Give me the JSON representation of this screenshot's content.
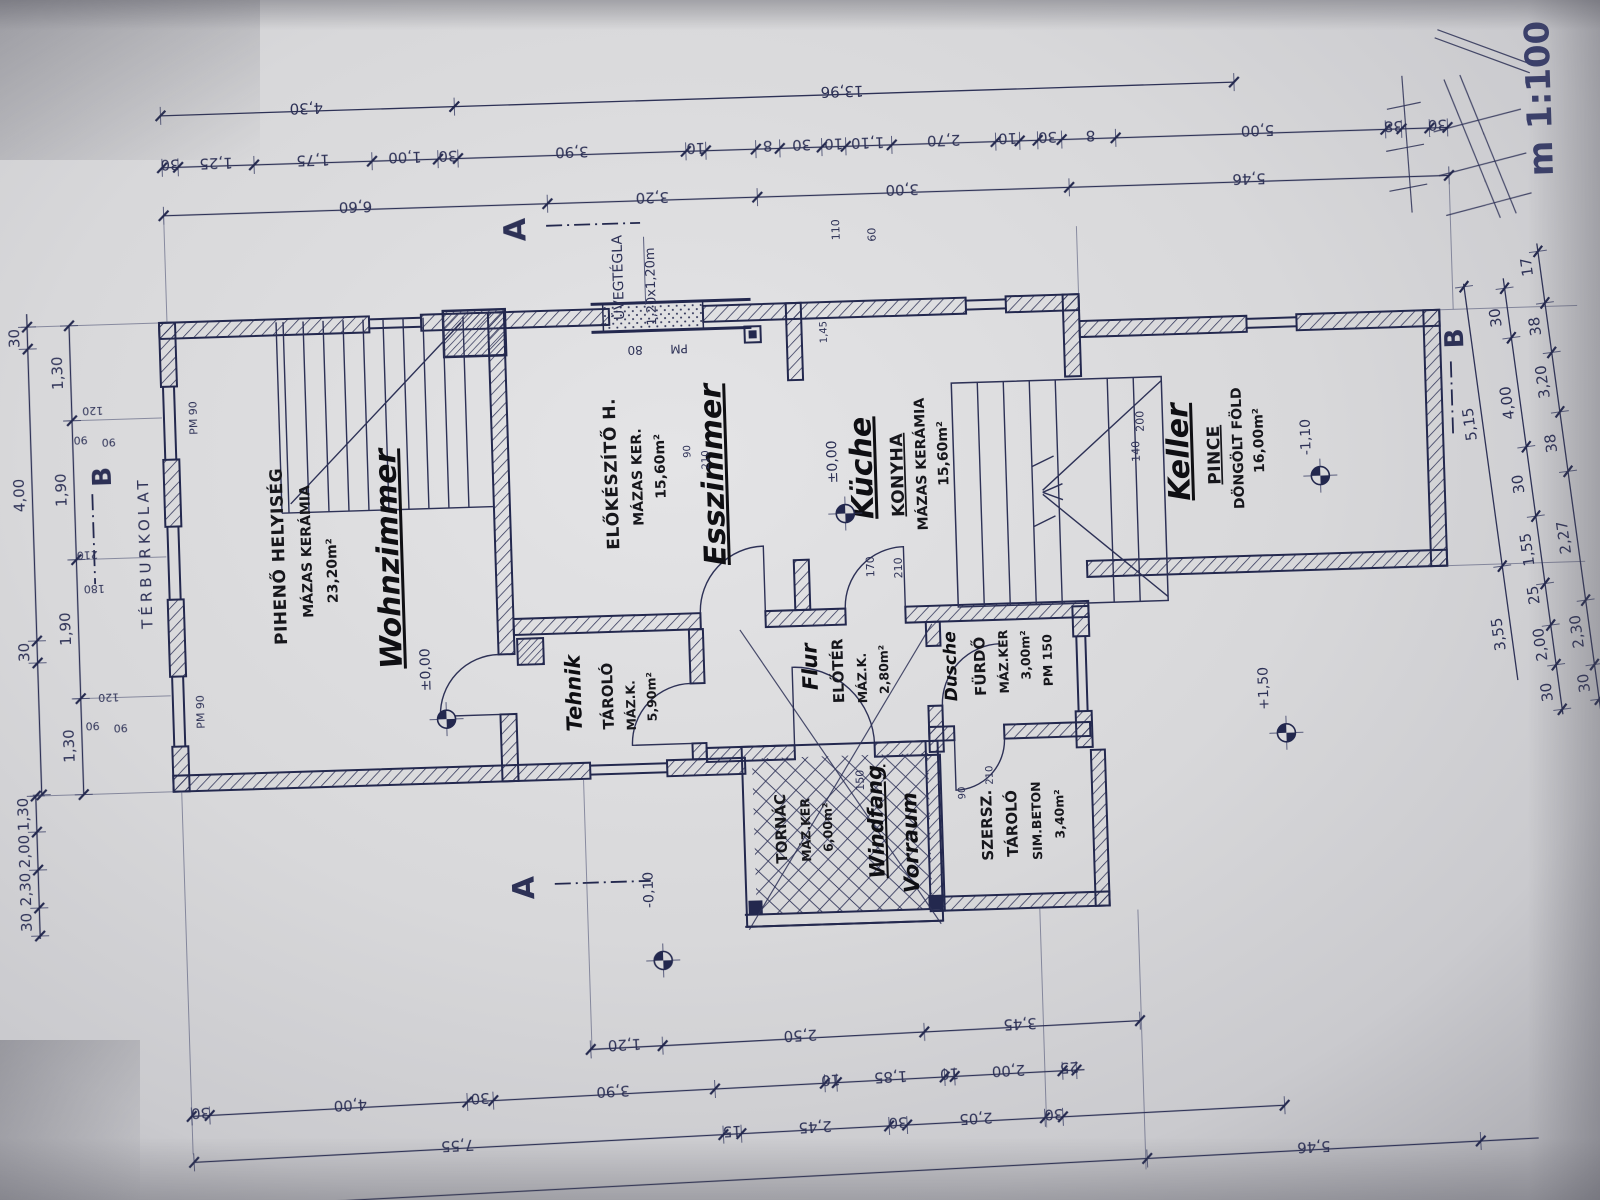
{
  "meta": {
    "scale_note": "m 1:100",
    "ink": "#2d3156",
    "marker": "#141418",
    "paper": "#d6d6d9"
  },
  "rooms": [
    {
      "key": "wohnzimmer",
      "lines": [
        {
          "t": "PIHENŐ HELYISÉG",
          "x": 286,
          "y": 540,
          "c": "room-hu"
        },
        {
          "t": "MÁZAS KERÁMIA",
          "x": 313,
          "y": 536,
          "c": "room-sub"
        },
        {
          "t": "23,20m²",
          "x": 338,
          "y": 556,
          "c": "room-sub"
        },
        {
          "t": "Wohnzimmer",
          "x": 400,
          "y": 546,
          "c": "hand hand-big u"
        }
      ]
    },
    {
      "key": "esszimmer",
      "lines": [
        {
          "t": "ELŐKÉSZÍTŐ H.",
          "x": 621,
          "y": 468,
          "c": "room-hu"
        },
        {
          "t": "MÁZAS KER.",
          "x": 646,
          "y": 472,
          "c": "room-sub"
        },
        {
          "t": "15,60m²",
          "x": 669,
          "y": 462,
          "c": "room-sub"
        },
        {
          "t": "Esszimmer",
          "x": 727,
          "y": 472,
          "c": "hand hand-big u"
        }
      ]
    },
    {
      "key": "kueche",
      "lines": [
        {
          "t": "Küche",
          "x": 876,
          "y": 470,
          "c": "hand hand-big u"
        },
        {
          "t": "KONYHA",
          "x": 907,
          "y": 478,
          "c": "room-hu u"
        },
        {
          "t": "MÁZAS KERÁMIA",
          "x": 930,
          "y": 468,
          "c": "room-sub"
        },
        {
          "t": "15,60m²",
          "x": 952,
          "y": 458,
          "c": "room-sub"
        }
      ]
    },
    {
      "key": "keller",
      "lines": [
        {
          "t": "Keller",
          "x": 1193,
          "y": 464,
          "c": "hand hand-big u"
        },
        {
          "t": "PINCE",
          "x": 1224,
          "y": 468,
          "c": "room-hu u"
        },
        {
          "t": "DÖNGÖLT FÖLD",
          "x": 1247,
          "y": 462,
          "c": "room-sub"
        },
        {
          "t": "16,00m²",
          "x": 1268,
          "y": 455,
          "c": "room-sub"
        }
      ]
    },
    {
      "key": "tarolo",
      "lines": [
        {
          "t": "Tehnik",
          "x": 578,
          "y": 686,
          "c": "hand hand-med"
        },
        {
          "t": "TÁROLÓ",
          "x": 610,
          "y": 690,
          "c": "room-hu-sm"
        },
        {
          "t": "MÁZ.K.",
          "x": 632,
          "y": 700,
          "c": "room-sub-sm"
        },
        {
          "t": "5,90m²",
          "x": 653,
          "y": 692,
          "c": "room-sub-sm"
        }
      ]
    },
    {
      "key": "flur",
      "lines": [
        {
          "t": "Flur",
          "x": 815,
          "y": 667,
          "c": "hand hand-med"
        },
        {
          "t": "ELŐTÉR",
          "x": 841,
          "y": 672,
          "c": "room-hu-sm"
        },
        {
          "t": "MÁZ.K.",
          "x": 864,
          "y": 680,
          "c": "room-sub-sm"
        },
        {
          "t": "2,80m²",
          "x": 886,
          "y": 672,
          "c": "room-sub-sm"
        }
      ]
    },
    {
      "key": "fuerdo",
      "lines": [
        {
          "t": "Dusche",
          "x": 954,
          "y": 671,
          "c": "hand hand-sm"
        },
        {
          "t": "FÜRDŐ",
          "x": 983,
          "y": 672,
          "c": "room-hu-sm"
        },
        {
          "t": "MÁZ.KER",
          "x": 1006,
          "y": 668,
          "c": "room-sub-sm"
        },
        {
          "t": "3,00m²",
          "x": 1028,
          "y": 662,
          "c": "room-sub-sm"
        },
        {
          "t": "PM 150",
          "x": 1050,
          "y": 668,
          "c": "room-sub-sm"
        }
      ]
    },
    {
      "key": "tornac",
      "lines": [
        {
          "t": "TORNÁC",
          "x": 779,
          "y": 828,
          "c": "room-hu-sm"
        },
        {
          "t": "MÁZ.KER",
          "x": 803,
          "y": 830,
          "c": "room-sub-sm"
        },
        {
          "t": "6,00m²",
          "x": 825,
          "y": 828,
          "c": "room-sub-sm"
        },
        {
          "t": "Windfang",
          "x": 876,
          "y": 824,
          "c": "hand hand-med u"
        },
        {
          "t": "Vorraum",
          "x": 910,
          "y": 846,
          "c": "hand hand-med"
        }
      ]
    },
    {
      "key": "szersz",
      "lines": [
        {
          "t": "SZERSZ.",
          "x": 985,
          "y": 831,
          "c": "room-hu-sm"
        },
        {
          "t": "TÁROLÓ",
          "x": 1010,
          "y": 830,
          "c": "room-hu-sm"
        },
        {
          "t": "SIM.BETON",
          "x": 1034,
          "y": 828,
          "c": "room-sub-sm"
        },
        {
          "t": "3,40m²",
          "x": 1057,
          "y": 822,
          "c": "room-sub-sm"
        }
      ]
    }
  ],
  "labels": [
    {
      "t": "m 1:100",
      "x": 1566,
      "y": 122,
      "s": 34,
      "c": "ann scale",
      "n": "scale-note"
    },
    {
      "t": "TÉRBURKOLAT",
      "x": 152,
      "y": 532,
      "s": 15,
      "c": "ann ls",
      "n": "terburkolat-label"
    },
    {
      "t": "ÜVEGTÉGLA",
      "x": 633,
      "y": 272,
      "s": 14,
      "c": "ann",
      "n": "glass-block-label"
    },
    {
      "t": "1,20x1,20m",
      "x": 665,
      "y": 282,
      "s": 13,
      "c": "ann",
      "n": "glass-block-size"
    },
    {
      "t": "80",
      "x": 643,
      "y": 341,
      "r": 180,
      "s": 12,
      "c": "ann"
    },
    {
      "t": "PM",
      "x": 687,
      "y": 341,
      "r": 180,
      "s": 12,
      "c": "ann"
    },
    {
      "t": "PM 90",
      "x": 203,
      "y": 399,
      "s": 11,
      "c": "ann"
    },
    {
      "t": "PM 90",
      "x": 201,
      "y": 693,
      "s": 11,
      "c": "ann"
    },
    {
      "t": "120",
      "x": 99,
      "y": 385,
      "r": 180,
      "s": 11,
      "c": "ann"
    },
    {
      "t": "90",
      "x": 86,
      "y": 414,
      "r": 180,
      "s": 11,
      "c": "ann"
    },
    {
      "t": "90",
      "x": 114,
      "y": 417,
      "r": 180,
      "s": 11,
      "c": "ann"
    },
    {
      "t": "210",
      "x": 89,
      "y": 529,
      "r": 180,
      "s": 11,
      "c": "ann"
    },
    {
      "t": "180",
      "x": 95,
      "y": 563,
      "r": 180,
      "s": 11,
      "c": "ann"
    },
    {
      "t": "120",
      "x": 106,
      "y": 672,
      "r": 180,
      "s": 11,
      "c": "ann"
    },
    {
      "t": "90",
      "x": 89,
      "y": 700,
      "r": 180,
      "s": 11,
      "c": "ann"
    },
    {
      "t": "90",
      "x": 117,
      "y": 703,
      "r": 180,
      "s": 11,
      "c": "ann"
    },
    {
      "t": "110",
      "x": 851,
      "y": 231,
      "s": 11,
      "c": "ann"
    },
    {
      "t": "60",
      "x": 887,
      "y": 237,
      "s": 11,
      "c": "ann"
    },
    {
      "t": "1,45",
      "x": 835,
      "y": 333,
      "s": 10,
      "c": "ann"
    },
    {
      "t": "170",
      "x": 875,
      "y": 569,
      "s": 11,
      "c": "ann"
    },
    {
      "t": "210",
      "x": 903,
      "y": 571,
      "s": 11,
      "c": "ann"
    },
    {
      "t": "90",
      "x": 695,
      "y": 448,
      "s": 10,
      "c": "ann"
    },
    {
      "t": "210",
      "x": 713,
      "y": 457,
      "s": 10,
      "c": "ann"
    },
    {
      "t": "150",
      "x": 858,
      "y": 782,
      "s": 11,
      "c": "ann"
    },
    {
      "t": "90",
      "x": 959,
      "y": 798,
      "s": 10,
      "c": "ann"
    },
    {
      "t": "210",
      "x": 987,
      "y": 781,
      "s": 10,
      "c": "ann"
    },
    {
      "t": "200",
      "x": 1149,
      "y": 432,
      "s": 11,
      "c": "ann"
    },
    {
      "t": "140",
      "x": 1144,
      "y": 462,
      "s": 11,
      "c": "ann"
    },
    {
      "t": "±0,00",
      "x": 428,
      "y": 658,
      "s": 14,
      "c": "ann"
    },
    {
      "t": "±0,00",
      "x": 841,
      "y": 463,
      "s": 14,
      "c": "ann"
    },
    {
      "t": "-0,10",
      "x": 644,
      "y": 885,
      "s": 14,
      "c": "ann"
    },
    {
      "t": "+1,50",
      "x": 1265,
      "y": 703,
      "s": 14,
      "c": "ann"
    },
    {
      "t": "-1,10",
      "x": 1315,
      "y": 453,
      "s": 14,
      "c": "ann"
    },
    {
      "t": "A",
      "x": 537,
      "y": 221,
      "s": 30,
      "c": "ann secb",
      "n": "section-a-top"
    },
    {
      "t": "A",
      "x": 525,
      "y": 879,
      "s": 30,
      "c": "ann secb",
      "n": "section-a-bottom"
    },
    {
      "t": "B",
      "x": 115,
      "y": 455,
      "s": 26,
      "c": "ann secb",
      "n": "section-b-left"
    },
    {
      "t": "B",
      "x": 1471,
      "y": 359,
      "s": 26,
      "c": "ann secb",
      "n": "section-b-right"
    }
  ],
  "chains": [
    {
      "g": "top",
      "o": "h",
      "pos": 96,
      "from": 176,
      "to": 1250,
      "ticks": [
        176,
        470,
        1250
      ],
      "labels": [
        {
          "t": "4,30",
          "at": 322
        },
        {
          "t": "13,96",
          "at": 858
        }
      ]
    },
    {
      "g": "top",
      "o": "h",
      "pos": 148,
      "from": 176,
      "to": 1462,
      "ticks": [
        176,
        192,
        268,
        386,
        452,
        472,
        700,
        720,
        770,
        794,
        836,
        860,
        906,
        1010,
        1034,
        1052,
        1076,
        1130,
        1400,
        1416,
        1444,
        1462
      ],
      "labels": [
        {
          "t": "30",
          "at": 184
        },
        {
          "t": "1,25",
          "at": 230
        },
        {
          "t": "1,75",
          "at": 327
        },
        {
          "t": "1,00",
          "at": 419
        },
        {
          "t": "30",
          "at": 462
        },
        {
          "t": "3,90",
          "at": 586
        },
        {
          "t": "10",
          "at": 710
        },
        {
          "t": "8",
          "at": 782
        },
        {
          "t": "30",
          "at": 816
        },
        {
          "t": "10",
          "at": 848
        },
        {
          "t": "1,10",
          "at": 882
        },
        {
          "t": "2,70",
          "at": 958
        },
        {
          "t": "10",
          "at": 1022
        },
        {
          "t": "30",
          "at": 1062
        },
        {
          "t": "8",
          "at": 1105
        },
        {
          "t": "5,00",
          "at": 1272
        },
        {
          "t": "38",
          "at": 1408
        },
        {
          "t": "30",
          "at": 1452
        }
      ]
    },
    {
      "g": "top",
      "o": "h",
      "pos": 196,
      "from": 176,
      "to": 1462,
      "ticks": [
        176,
        560,
        770,
        1082,
        1462
      ],
      "labels": [
        {
          "t": "6,60",
          "at": 368
        },
        {
          "t": "3,20",
          "at": 665
        },
        {
          "t": "3,00",
          "at": 915
        },
        {
          "t": "5,46",
          "at": 1262
        }
      ]
    },
    {
      "g": "bottom",
      "o": "h",
      "pos": 1038,
      "from": 578,
      "to": 1128,
      "ticks": [
        578,
        650,
        912,
        1128
      ],
      "labels": [
        {
          "t": "1,20",
          "at": 612
        },
        {
          "t": "2,50",
          "at": 788
        },
        {
          "t": "3,45",
          "at": 1008
        }
      ]
    },
    {
      "g": "bottom",
      "o": "h",
      "pos": 1084,
      "from": 176,
      "to": 1070,
      "ticks": [
        176,
        194,
        452,
        478,
        700,
        810,
        822,
        930,
        940,
        1048,
        1062
      ],
      "labels": [
        {
          "t": "30",
          "at": 185
        },
        {
          "t": "4,00",
          "at": 335
        },
        {
          "t": "30",
          "at": 465
        },
        {
          "t": "3,90",
          "at": 598
        },
        {
          "t": "10",
          "at": 816
        },
        {
          "t": "1,85",
          "at": 876
        },
        {
          "t": "10",
          "at": 935
        },
        {
          "t": "2,00",
          "at": 994
        },
        {
          "t": "25",
          "at": 1055
        }
      ]
    },
    {
      "g": "bottom",
      "o": "h",
      "pos": 1130,
      "from": 176,
      "to": 1268,
      "ticks": [
        176,
        706,
        724,
        872,
        890,
        1028,
        1046,
        1268
      ],
      "labels": [
        {
          "t": "7,55",
          "at": 440
        },
        {
          "t": "15",
          "at": 715
        },
        {
          "t": "2,45",
          "at": 798
        },
        {
          "t": "30",
          "at": 881
        },
        {
          "t": "2,05",
          "at": 959
        },
        {
          "t": "30",
          "at": 1037
        }
      ]
    },
    {
      "g": "bottom",
      "o": "h",
      "pos": 1176,
      "from": 150,
      "to": 1520,
      "ticks": [
        1128,
        1462
      ],
      "labels": [
        {
          "t": "5,46",
          "at": 1295
        }
      ]
    },
    {
      "g": "left",
      "o": "v",
      "pos": 78,
      "from": 303,
      "to": 772,
      "ticks": [
        303,
        398,
        537,
        676,
        772
      ],
      "labels": [
        {
          "t": "1,30",
          "at": 350
        },
        {
          "t": "1,90",
          "at": 467
        },
        {
          "t": "1,90",
          "at": 606
        },
        {
          "t": "1,30",
          "at": 723
        }
      ]
    },
    {
      "g": "left",
      "o": "v",
      "pos": 36,
      "from": 290,
      "to": 772,
      "ticks": [
        303,
        325,
        617,
        639,
        771
      ],
      "labels": [
        {
          "t": "30",
          "at": 314
        },
        {
          "t": "4,00",
          "at": 471
        },
        {
          "t": "30",
          "at": 628
        }
      ]
    },
    {
      "g": "left",
      "o": "v",
      "pos": 30,
      "from": 772,
      "to": 915,
      "ticks": [
        772,
        808,
        846,
        884,
        912
      ],
      "labels": [
        {
          "t": "1,30",
          "at": 790
        },
        {
          "t": "2,00",
          "at": 827
        },
        {
          "t": "2,30",
          "at": 865
        },
        {
          "t": "30",
          "at": 898
        }
      ]
    },
    {
      "g": "right",
      "o": "v",
      "pos": 1496,
      "from": 300,
      "to": 700,
      "ticks": [
        303,
        585
      ],
      "labels": [
        {
          "t": "5,15",
          "at": 440
        },
        {
          "t": "3,55",
          "at": 652
        }
      ]
    },
    {
      "g": "right",
      "o": "v",
      "pos": 1536,
      "from": 300,
      "to": 740,
      "ticks": [
        310,
        360,
        470,
        540,
        608,
        650,
        690,
        735
      ],
      "labels": [
        {
          "t": "30",
          "at": 338
        },
        {
          "t": "4,00",
          "at": 424
        },
        {
          "t": "30",
          "at": 506
        },
        {
          "t": "1,55",
          "at": 572
        },
        {
          "t": "25",
          "at": 618
        },
        {
          "t": "2,00",
          "at": 668
        },
        {
          "t": "30",
          "at": 716
        }
      ]
    },
    {
      "g": "right",
      "o": "v",
      "pos": 1574,
      "from": 270,
      "to": 740,
      "ticks": [
        278,
        330,
        380,
        440,
        500,
        630,
        695,
        730
      ],
      "labels": [
        {
          "t": "17",
          "at": 292
        },
        {
          "t": "38",
          "at": 352
        },
        {
          "t": "3,20",
          "at": 408
        },
        {
          "t": "38",
          "at": 470
        },
        {
          "t": "2,27",
          "at": 565
        },
        {
          "t": "2,30",
          "at": 660
        },
        {
          "t": "30",
          "at": 712
        }
      ]
    }
  ],
  "elev_points": [
    {
      "x": 443,
      "y": 708
    },
    {
      "x": 848,
      "y": 515
    },
    {
      "x": 652,
      "y": 956
    },
    {
      "x": 1282,
      "y": 748
    },
    {
      "x": 1324,
      "y": 492
    }
  ]
}
